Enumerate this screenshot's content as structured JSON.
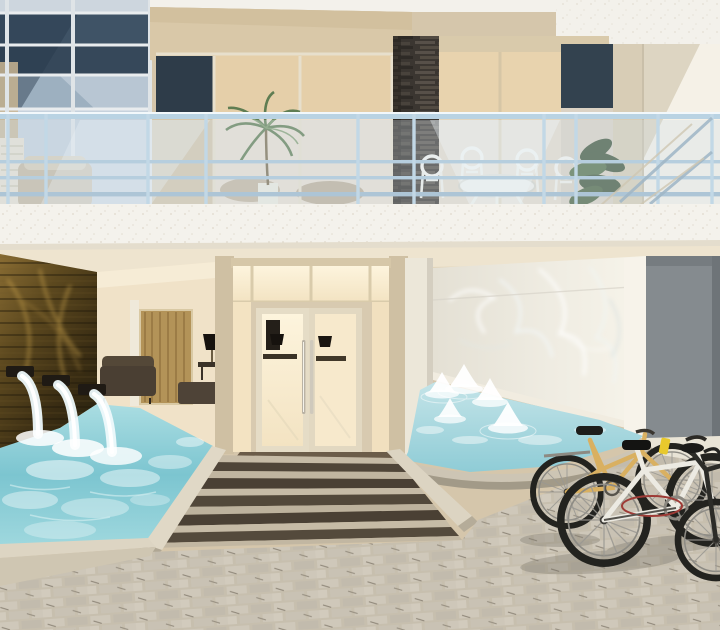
{
  "scene": {
    "type": "architectural-rendering",
    "alt": "Photorealistic rendering of a modern residential building entrance: an upper balcony with glass-and-metal railing, white outdoor furniture and palm plants sits above a recessed ground floor lobby with glass double doors. A dark wood feature wall with three waterfall spouts pours into a turquoise pool on the left; a second pool with small bell fountains sits on the right against a wall lit by water caustics. A striped stone walkway leads to the doors across a light paver plaza where several bicycles are parked.",
    "objects": [
      {
        "name": "glass-curtain-wall",
        "description": "blue reflective window grid, upper left"
      },
      {
        "name": "balcony-railing",
        "description": "light metal rails with glass panels"
      },
      {
        "name": "outdoor-dining-set",
        "description": "white round-back chairs and table on balcony"
      },
      {
        "name": "palm-plant",
        "description": "potted palm on balcony"
      },
      {
        "name": "stone-column",
        "description": "dark stacked-stone pillar on balcony"
      },
      {
        "name": "balcony-slab",
        "description": "white speckled concrete band"
      },
      {
        "name": "wood-feature-wall",
        "description": "dark wood wall with golden light and 3 waterfall spouts"
      },
      {
        "name": "left-pool",
        "description": "churning turquoise pool fed by waterfalls"
      },
      {
        "name": "lobby-interior",
        "description": "warm lit lounge with dark sofa, bronze screen and black lamp"
      },
      {
        "name": "entrance-doors",
        "description": "glass double doors with long vertical handles"
      },
      {
        "name": "caustic-wall",
        "description": "pale wall with rippling water light reflections"
      },
      {
        "name": "gray-panel",
        "description": "slate gray wall panel, far right"
      },
      {
        "name": "right-pool-fountains",
        "description": "pool with five small bell fountains"
      },
      {
        "name": "walkway-steps",
        "description": "striped dark/light paver ramp to the doors"
      },
      {
        "name": "paver-plaza",
        "description": "light gray stone paver forecourt"
      },
      {
        "name": "bicycles",
        "description": "tan city bike, white bike with red lock, dark bike"
      }
    ]
  },
  "palette": {
    "tanWall": "#d5c6ab",
    "soffit": "#d9c8a8",
    "slab": "#f4f2ec",
    "glassDark": "#3f5366",
    "glassMid": "#8fa3b4",
    "glassLight": "#c6d2dd",
    "railMetal": "#b9d3e3",
    "stone": "#3b3631",
    "whiteWall": "#f5f1e7",
    "grayPanel": "#858b8f",
    "lobbyWall": "#f0e2c8",
    "doorGlass": "#f8ecd2",
    "frameBeige": "#cfc0a3",
    "causticWall": "#ebe8e0",
    "waterLeft": "#7cc5d0",
    "waterRight": "#9fd4dd",
    "curb": "#d9d1bf",
    "plaza": "#c7bfae",
    "stripeDark": "#4f4538",
    "stripeLight": "#c6bba6",
    "wood": "#4a3a20",
    "bikeTan": "#d9b061",
    "bikeWhite": "#eceae2",
    "bikeDark": "#23231f",
    "accentYellow": "#e8c92d",
    "accentRed": "#9e3b36"
  }
}
